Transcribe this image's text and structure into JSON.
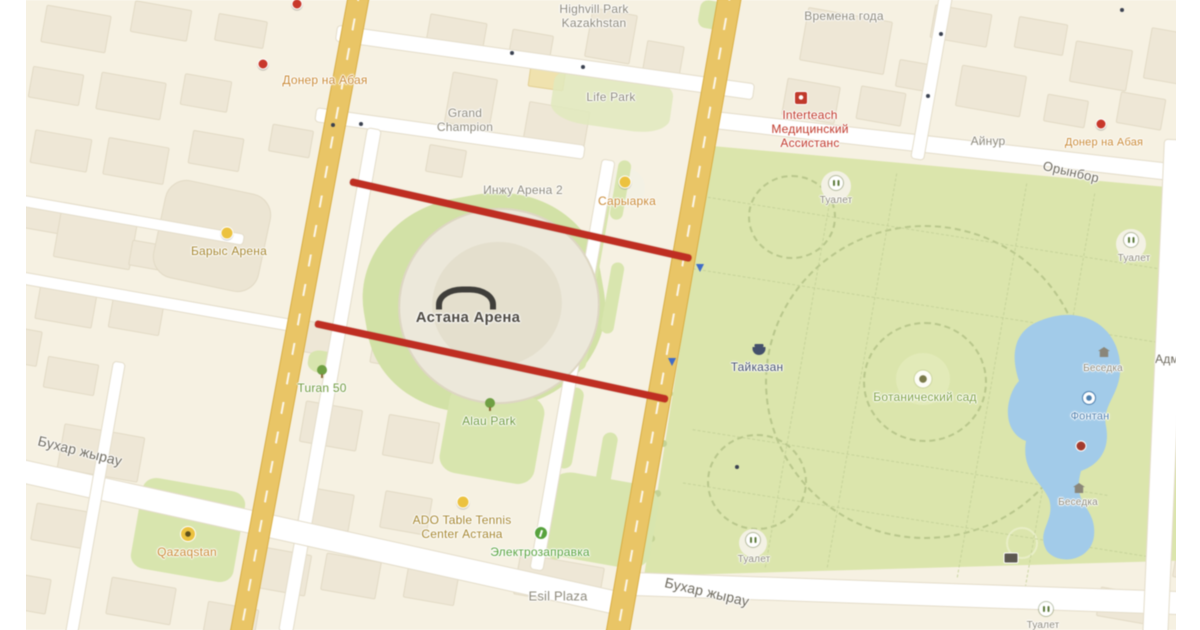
{
  "colors": {
    "closure_red": "#bf2e22",
    "park_green": "#dbe5ac",
    "lake_blue": "#a2cbe9",
    "road_yellow": "#e9c566",
    "poi_gray": "#8d897b",
    "poi_orange": "#c98a35",
    "poi_dark_yellow": "#a5862f",
    "poi_red": "#c0392b",
    "poi_green": "#6f9a3f",
    "poi_green_bright": "#57a23d",
    "park_name_green": "#7fa144",
    "poi_navy": "#44506b",
    "poi_blue": "#4d7fae",
    "label_dark": "#4e4a42",
    "street_gray": "#6e6a5e"
  },
  "annotations": {
    "closure_lines": [
      {
        "x1": 350,
        "y1": 181,
        "x2": 691,
        "y2": 258
      },
      {
        "x1": 315,
        "y1": 323,
        "x2": 668,
        "y2": 399
      }
    ]
  },
  "map": {
    "labels": [
      {
        "name": "poi-label-highvill-park",
        "text": "Highvill Park\nKazakhstan",
        "x": 594,
        "y": 16,
        "color": "poi_gray",
        "fs": 12,
        "rot": 0,
        "inter": true
      },
      {
        "name": "poi-label-life-park",
        "text": "Life Park",
        "x": 611,
        "y": 97,
        "color": "poi_gray",
        "fs": 12,
        "rot": 0,
        "inter": true
      },
      {
        "name": "poi-label-doner-abaya-left",
        "text": "Донер на Абая",
        "x": 325,
        "y": 80,
        "color": "poi_orange",
        "fs": 12,
        "rot": 0,
        "inter": true
      },
      {
        "name": "poi-label-grand-champion",
        "text": "Grand\nChampion",
        "x": 465,
        "y": 120,
        "color": "poi_gray",
        "fs": 12,
        "rot": 0,
        "inter": true
      },
      {
        "name": "poi-label-vremena-goda",
        "text": "Времена года",
        "x": 844,
        "y": 16,
        "color": "poi_gray",
        "fs": 12,
        "rot": 0,
        "inter": true
      },
      {
        "name": "poi-label-interteach",
        "text": "Interteach\nМедицинский\nАссистанс",
        "x": 810,
        "y": 129,
        "color": "poi_red",
        "fs": 12,
        "rot": 0,
        "inter": true
      },
      {
        "name": "poi-label-ainur",
        "text": "Айнур",
        "x": 988,
        "y": 141,
        "color": "poi_gray",
        "fs": 12,
        "rot": 0,
        "inter": true
      },
      {
        "name": "poi-label-doner-abaya-right",
        "text": "Донер на Абая",
        "x": 1104,
        "y": 143,
        "color": "poi_orange",
        "fs": 11,
        "rot": 0,
        "inter": true
      },
      {
        "name": "street-label-orynbor",
        "text": "Орынбор",
        "x": 1071,
        "y": 172,
        "color": "street_gray",
        "fs": 13,
        "rot": 13,
        "inter": false
      },
      {
        "name": "poi-label-inzhu-arena-2",
        "text": "Инжу Арена 2",
        "x": 523,
        "y": 190,
        "color": "poi_gray",
        "fs": 12,
        "rot": 0,
        "inter": true
      },
      {
        "name": "poi-label-saryarka",
        "text": "Сарыарка",
        "x": 627,
        "y": 201,
        "color": "poi_orange",
        "fs": 12,
        "rot": 0,
        "inter": true
      },
      {
        "name": "poi-label-barys-arena",
        "text": "Барыс Арена",
        "x": 229,
        "y": 251,
        "color": "poi_dark_yellow",
        "fs": 12,
        "rot": 0,
        "inter": true
      },
      {
        "name": "poi-label-astana-arena",
        "text": "Астана Арена",
        "x": 468,
        "y": 318,
        "color": "label_dark",
        "fs": 15,
        "rot": 0,
        "inter": true,
        "bold": true
      },
      {
        "name": "poi-label-taikazan",
        "text": "Тайказан",
        "x": 757,
        "y": 367,
        "color": "poi_navy",
        "fs": 12,
        "rot": 0,
        "inter": true
      },
      {
        "name": "poi-label-botanical-garden",
        "text": "Ботанический сад",
        "x": 925,
        "y": 397,
        "color": "park_name_green",
        "fs": 12,
        "rot": 0,
        "inter": true
      },
      {
        "name": "poi-label-toilet-1",
        "text": "Туалет",
        "x": 836,
        "y": 201,
        "color": "poi_gray",
        "fs": 10,
        "rot": 0,
        "inter": true
      },
      {
        "name": "poi-label-toilet-2",
        "text": "Туалет",
        "x": 1134,
        "y": 259,
        "color": "poi_gray",
        "fs": 10,
        "rot": 0,
        "inter": true
      },
      {
        "name": "poi-label-toilet-3",
        "text": "Туалет",
        "x": 754,
        "y": 560,
        "color": "poi_gray",
        "fs": 10,
        "rot": 0,
        "inter": true
      },
      {
        "name": "poi-label-toilet-4",
        "text": "Туалет",
        "x": 1043,
        "y": 626,
        "color": "poi_gray",
        "fs": 10,
        "rot": 0,
        "inter": true
      },
      {
        "name": "poi-label-fountain",
        "text": "Фонтан",
        "x": 1090,
        "y": 417,
        "color": "poi_blue",
        "fs": 11,
        "rot": 0,
        "inter": true
      },
      {
        "name": "poi-label-besedka-1",
        "text": "Беседка",
        "x": 1103,
        "y": 369,
        "color": "poi_gray",
        "fs": 10,
        "rot": 0,
        "inter": true
      },
      {
        "name": "poi-label-besedka-2",
        "text": "Беседка",
        "x": 1078,
        "y": 503,
        "color": "poi_gray",
        "fs": 10,
        "rot": 0,
        "inter": true
      },
      {
        "name": "poi-label-turan-50",
        "text": "Turan 50",
        "x": 322,
        "y": 388,
        "color": "poi_green",
        "fs": 12,
        "rot": 0,
        "inter": true
      },
      {
        "name": "poi-label-alau-park",
        "text": "Alau Park",
        "x": 489,
        "y": 421,
        "color": "poi_green",
        "fs": 12,
        "rot": 0,
        "inter": true
      },
      {
        "name": "street-label-bukhar-zhyrau-left",
        "text": "Бухар жырау",
        "x": 80,
        "y": 451,
        "color": "street_gray",
        "fs": 14,
        "rot": 14,
        "inter": false
      },
      {
        "name": "poi-label-qazaqstan",
        "text": "Qazaqstan",
        "x": 187,
        "y": 552,
        "color": "poi_orange",
        "fs": 12,
        "rot": 0,
        "inter": true
      },
      {
        "name": "poi-label-ado-table-tennis",
        "text": "ADO Table Tennis\nCenter Астана",
        "x": 462,
        "y": 527,
        "color": "poi_dark_yellow",
        "fs": 12,
        "rot": 0,
        "inter": true
      },
      {
        "name": "poi-label-electrozapravka",
        "text": "Электрозаправка",
        "x": 540,
        "y": 552,
        "color": "poi_green_bright",
        "fs": 12,
        "rot": 0,
        "inter": true
      },
      {
        "name": "poi-label-esil-plaza",
        "text": "Esil Plaza",
        "x": 558,
        "y": 596,
        "color": "poi_gray",
        "fs": 13,
        "rot": 0,
        "inter": true
      },
      {
        "name": "street-label-bukhar-zhyrau-right",
        "text": "Бухар жырау",
        "x": 707,
        "y": 592,
        "color": "street_gray",
        "fs": 14,
        "rot": 13,
        "inter": false
      },
      {
        "name": "street-label-adm-partial",
        "text": "Адм",
        "x": 1167,
        "y": 359,
        "color": "street_gray",
        "fs": 12,
        "rot": 0,
        "inter": false
      }
    ],
    "icons": [
      {
        "name": "doner-left-pin-icon",
        "type": "ic-pin-red",
        "x": 263,
        "y": 64,
        "inter": true
      },
      {
        "name": "doner-top-pin-icon",
        "type": "ic-pin-red",
        "x": 297,
        "y": 4,
        "inter": true
      },
      {
        "name": "doner-right-pin-icon",
        "type": "ic-pin-red",
        "x": 1101,
        "y": 124,
        "inter": true
      },
      {
        "name": "interteach-icon",
        "type": "ic-sq-red",
        "x": 801,
        "y": 98,
        "inter": true
      },
      {
        "name": "saryarka-icon",
        "type": "ic-dot-yellow",
        "x": 625,
        "y": 182,
        "inter": true
      },
      {
        "name": "barys-arena-icon",
        "type": "ic-dot-yellow",
        "x": 227,
        "y": 233,
        "inter": true
      },
      {
        "name": "ado-icon",
        "type": "ic-dot-yellow",
        "x": 463,
        "y": 502,
        "inter": true
      },
      {
        "name": "qazaqstan-icon",
        "type": "ic-rad",
        "x": 188,
        "y": 534,
        "inter": true
      },
      {
        "name": "stadium-roof-icon",
        "type": "arch",
        "x": 466,
        "y": 298,
        "inter": false
      },
      {
        "name": "taikazan-icon",
        "type": "ic-navy",
        "x": 759,
        "y": 351,
        "inter": true
      },
      {
        "name": "toilet-icon",
        "type": "ic-wc",
        "x": 836,
        "y": 183,
        "inter": true
      },
      {
        "name": "toilet-icon",
        "type": "ic-wc",
        "x": 1131,
        "y": 240,
        "inter": true
      },
      {
        "name": "toilet-icon",
        "type": "ic-wc",
        "x": 753,
        "y": 540,
        "inter": true
      },
      {
        "name": "toilet-icon",
        "type": "ic-wc",
        "x": 1046,
        "y": 609,
        "inter": true
      },
      {
        "name": "fountain-icon",
        "type": "ic-fountain",
        "x": 1089,
        "y": 398,
        "inter": true
      },
      {
        "name": "besedka-icon",
        "type": "ic-besedka",
        "x": 1104,
        "y": 352,
        "inter": true
      },
      {
        "name": "besedka-icon",
        "type": "ic-besedka",
        "x": 1079,
        "y": 488,
        "inter": true
      },
      {
        "name": "tree-icon",
        "type": "ic-tree",
        "x": 322,
        "y": 370,
        "inter": false
      },
      {
        "name": "tree-icon",
        "type": "ic-tree",
        "x": 490,
        "y": 403,
        "inter": false
      },
      {
        "name": "electro-icon",
        "type": "ic-elec",
        "x": 541,
        "y": 533,
        "inter": true
      },
      {
        "name": "park-badge-icon",
        "type": "ic-badge",
        "x": 1011,
        "y": 558,
        "inter": false
      },
      {
        "name": "lake-buoy-icon",
        "type": "ic-buoy",
        "x": 1081,
        "y": 446,
        "inter": true
      },
      {
        "name": "park-center-icon",
        "type": "ic-center",
        "x": 923,
        "y": 379,
        "inter": false
      },
      {
        "name": "nav-arrow-icon",
        "type": "ic-arrow-blue",
        "x": 700,
        "y": 268,
        "inter": false
      },
      {
        "name": "nav-arrow-icon",
        "type": "ic-arrow-blue",
        "x": 672,
        "y": 362,
        "inter": false
      },
      {
        "name": "traffic-dot-icon",
        "type": "ic-dot-dark",
        "x": 512,
        "y": 53,
        "inter": false
      },
      {
        "name": "traffic-dot-icon",
        "type": "ic-dot-dark",
        "x": 583,
        "y": 67,
        "inter": false
      },
      {
        "name": "traffic-dot-icon",
        "type": "ic-dot-dark",
        "x": 333,
        "y": 125,
        "inter": false
      },
      {
        "name": "traffic-dot-icon",
        "type": "ic-dot-dark",
        "x": 361,
        "y": 124,
        "inter": false
      },
      {
        "name": "traffic-dot-icon",
        "type": "ic-dot-dark",
        "x": 941,
        "y": 34,
        "inter": false
      },
      {
        "name": "traffic-dot-icon",
        "type": "ic-dot-dark",
        "x": 928,
        "y": 96,
        "inter": false
      },
      {
        "name": "traffic-dot-icon",
        "type": "ic-dot-dark",
        "x": 737,
        "y": 467,
        "inter": false
      },
      {
        "name": "traffic-dot-icon",
        "type": "ic-dot-dark",
        "x": 1122,
        "y": 10,
        "inter": false
      }
    ]
  }
}
